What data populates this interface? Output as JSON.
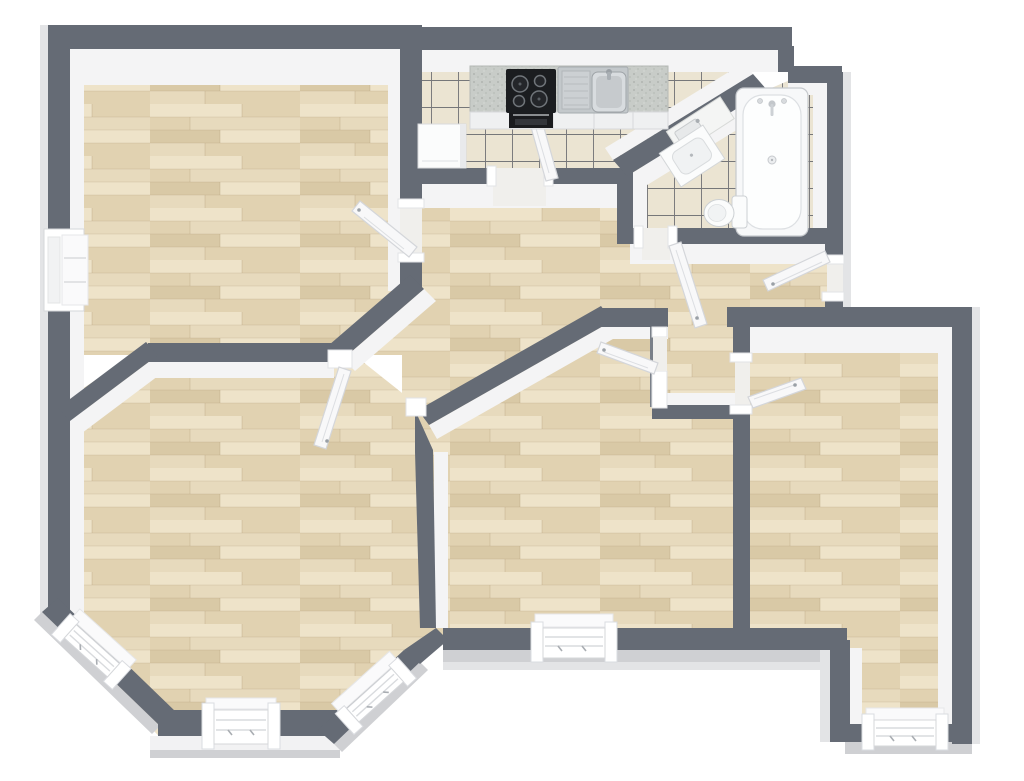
{
  "canvas": {
    "width": 1024,
    "height": 781,
    "background": "#ffffff"
  },
  "palette": {
    "bg": "#ffffff",
    "wall": "#656b75",
    "wall_light": "#7a8089",
    "wall_face": "#f4f4f5",
    "outer": "#cfd0d3",
    "outer_light": "#e3e4e6",
    "outer_white": "#f2f2f3",
    "wood_base": "#e7dabd",
    "wood_light": "#eee3c9",
    "wood_mid": "#e1d2b1",
    "wood_dark": "#d9c9a6",
    "tile": "#ebe4d2",
    "grout": "#4e525a",
    "counter": "#c8ccc8",
    "cooktop": "#1b1d20",
    "steel": "#c3c8cb",
    "fix_white": "#fbfcfc",
    "fix_line": "#ccd0d3",
    "door": "#f8f8f9",
    "door_edge": "#d4d6da"
  },
  "plan": {
    "type": "3d-floor-plan",
    "rooms": [
      {
        "id": "room-top-left",
        "name": "Room (top left)",
        "floor": "wood"
      },
      {
        "id": "kitchen",
        "name": "Kitchen",
        "floor": "tile"
      },
      {
        "id": "bathroom",
        "name": "Bathroom",
        "floor": "tile"
      },
      {
        "id": "hallway",
        "name": "Hallway",
        "floor": "wood"
      },
      {
        "id": "room-bottom-left",
        "name": "Room (bottom left, bay windows)",
        "floor": "wood"
      },
      {
        "id": "room-bottom-middle",
        "name": "Room (bottom middle)",
        "floor": "wood"
      },
      {
        "id": "room-right",
        "name": "Room (right, L-shaped)",
        "floor": "wood"
      }
    ],
    "fixtures": [
      {
        "id": "kitchen-counter",
        "name": "Kitchen counter"
      },
      {
        "id": "cooktop",
        "name": "Cooktop with 4 burners"
      },
      {
        "id": "oven",
        "name": "Oven"
      },
      {
        "id": "kitchen-sink",
        "name": "Kitchen sink with drainboard"
      },
      {
        "id": "refrigerator",
        "name": "Refrigerator cabinet"
      },
      {
        "id": "bathtub",
        "name": "Bathtub"
      },
      {
        "id": "washbasin-counter",
        "name": "Washbasin counter"
      },
      {
        "id": "washbasin-vanity",
        "name": "Washbasin vanity"
      },
      {
        "id": "toilet",
        "name": "Toilet"
      }
    ],
    "openings": {
      "doors": 7,
      "windows": 6,
      "wall_openings": 1
    }
  }
}
